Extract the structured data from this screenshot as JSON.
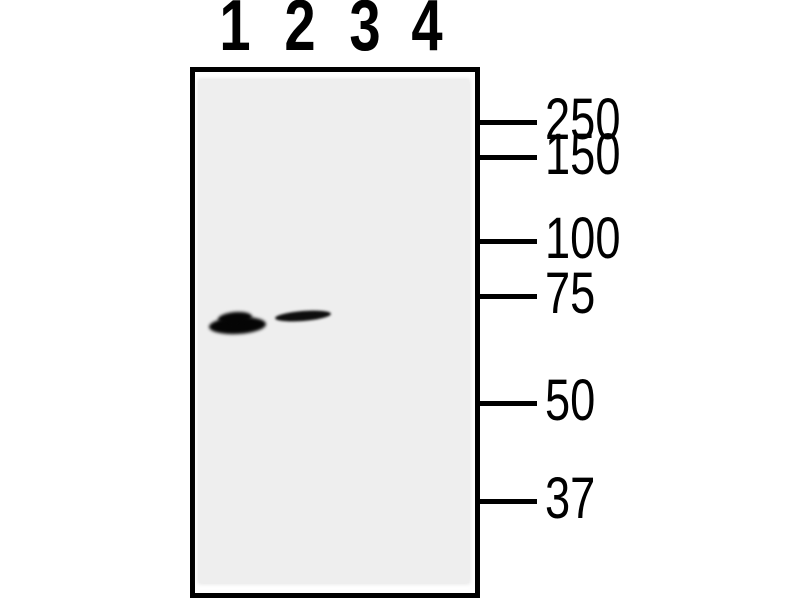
{
  "figure_type": "western-blot",
  "colors": {
    "background": "#ffffff",
    "panel_background": "#ffffff",
    "membrane": "#eeeeee",
    "ink": "#000000",
    "band": "#060606"
  },
  "blot": {
    "lanes": [
      {
        "label": "1",
        "x_center": 235
      },
      {
        "label": "2",
        "x_center": 300
      },
      {
        "label": "3",
        "x_center": 365
      },
      {
        "label": "4",
        "x_center": 427
      }
    ],
    "mw_markers": [
      {
        "label": "250",
        "tick_y": 122
      },
      {
        "label": "150",
        "tick_y": 157
      },
      {
        "label": "100",
        "tick_y": 241
      },
      {
        "label": "75",
        "tick_y": 296
      },
      {
        "label": "50",
        "tick_y": 403
      },
      {
        "label": "37",
        "tick_y": 501
      }
    ],
    "bands": [
      {
        "lane": "1",
        "intensity": "strong",
        "parts": [
          {
            "x": 209,
            "y": 317,
            "w": 57,
            "h": 17,
            "rotate": -3,
            "blur": 1.5,
            "color": "#050505"
          },
          {
            "x": 218,
            "y": 312,
            "w": 34,
            "h": 12,
            "rotate": -5,
            "blur": 1.5,
            "color": "#050505"
          }
        ]
      },
      {
        "lane": "2",
        "intensity": "weak",
        "parts": [
          {
            "x": 275,
            "y": 311,
            "w": 56,
            "h": 10,
            "rotate": -4.5,
            "blur": 1.3,
            "color": "#0d0d0d"
          }
        ]
      }
    ]
  }
}
